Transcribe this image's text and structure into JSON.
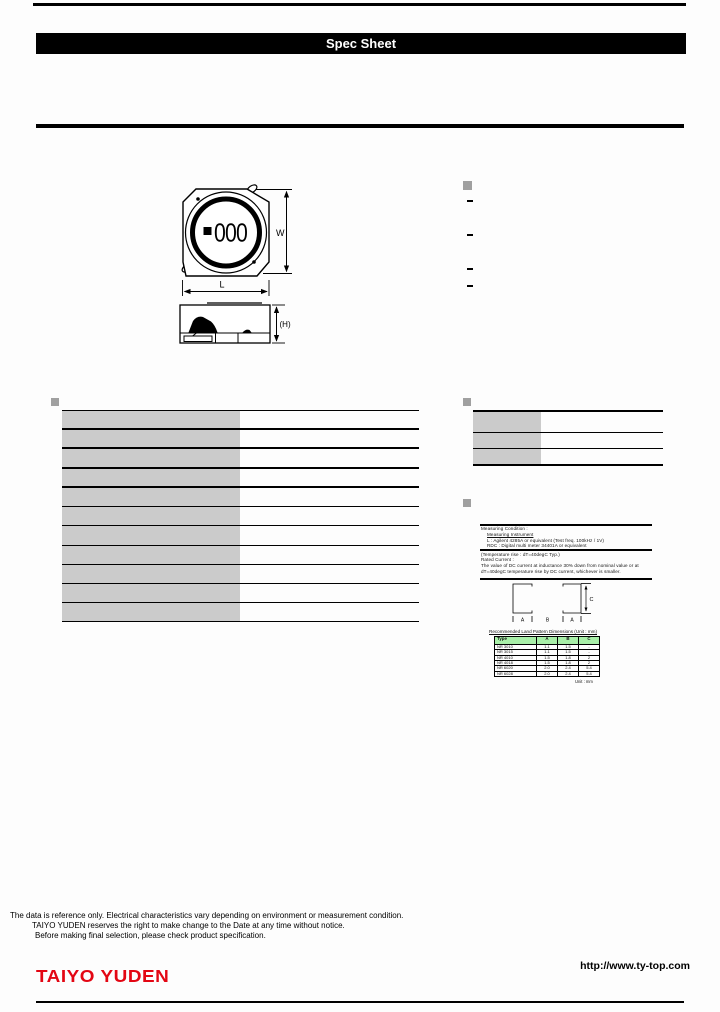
{
  "banner": {
    "title": "Spec Sheet"
  },
  "drawing": {
    "marking": "000",
    "dims": {
      "w": "W",
      "l": "L",
      "h": "(H)",
      "a": "A",
      "b": "B",
      "c": "C"
    }
  },
  "features": {
    "items": [
      "-",
      "-",
      "-",
      "-"
    ]
  },
  "spec_table": {
    "rows": [
      [
        "",
        ""
      ],
      [
        "",
        ""
      ],
      [
        "",
        ""
      ],
      [
        "",
        ""
      ],
      [
        "",
        ""
      ],
      [
        "",
        ""
      ],
      [
        "",
        ""
      ],
      [
        "",
        ""
      ],
      [
        "",
        ""
      ],
      [
        "",
        ""
      ],
      [
        "",
        ""
      ]
    ]
  },
  "part_table": {
    "rows": [
      [
        "",
        ""
      ],
      [
        "",
        ""
      ],
      [
        "",
        ""
      ]
    ]
  },
  "notes": {
    "block1": [
      "Measuring Condition :",
      "Measuring Instrument",
      "L : Agilent 4285A or equivalent (Test freq. 100kHz / 1V)",
      "RDC : Digital multi meter 34401A or equivalent"
    ],
    "block2": [
      "(Temperature rise : dT=40degC Typ.)",
      "Rated Current :",
      "The value of DC current at inductance 30% down from nominal value or at",
      "dT=40degC temperature rise by DC current, whichever is smaller."
    ]
  },
  "land_pattern": {
    "caption": "Recommended Land Pattern Dimensions (Unit : mm)",
    "table": {
      "headers": [
        "Type",
        "A",
        "B",
        "C"
      ],
      "rows": [
        [
          "NR 3010",
          "1.1",
          "1.5",
          "-"
        ],
        [
          "NR 3015",
          "1.1",
          "1.5",
          "-"
        ],
        [
          "NR 4010",
          "1.5",
          "1.8",
          "2"
        ],
        [
          "NR 4018",
          "1.5",
          "1.8",
          "2"
        ],
        [
          "NR 6020",
          "2.0",
          "2.4",
          "5.4"
        ],
        [
          "NR 6028",
          "2.0",
          "2.4",
          "5.4"
        ]
      ]
    },
    "footnote": "Unit : mm"
  },
  "footer": {
    "disclaimer": [
      "The data is reference only. Electrical characteristics vary depending on environment or measurement condition.",
      "TAIYO YUDEN reserves the right to make change to the Date at any time without notice.",
      "Before making final selection, please check product specification."
    ],
    "logo": "TAIYO YUDEN",
    "url": "http://www.ty-top.com"
  },
  "colors": {
    "accent_red": "#e30613",
    "cell_gray": "#cbcbcb",
    "bullet_gray": "#a0a0a0",
    "table_green": "#a8efa8"
  }
}
